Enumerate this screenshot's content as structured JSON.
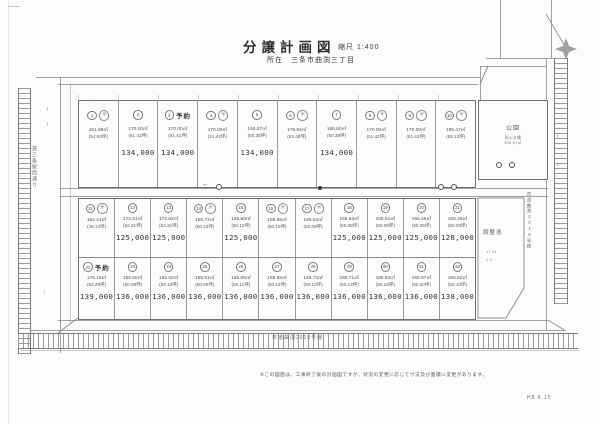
{
  "title": {
    "main": "分譲計画図",
    "scale": "縮尺 1:400",
    "location": "所在　三条市曲渕三丁目"
  },
  "roads": {
    "left_vertical": "燕三条駅西通り",
    "right_vertical": "市道曲渕2018号線",
    "bottom": "市道曲渕2019号線"
  },
  "facilities": {
    "park": {
      "label": "公園",
      "sub1": "防火水槽",
      "sub2": "306.67㎡"
    },
    "pond": {
      "label": "調整池",
      "fine1": "17.11",
      "fine2": "2.9"
    }
  },
  "footer": {
    "note": "※この図面は、工事終了後の計画図ですが、状況の変更に応じて寸法及び面積に変更があります。",
    "date": "H8 6.15"
  },
  "reserved_label": "予約",
  "icons": {
    "stamp_glyph": "✳",
    "arrow_left": "←",
    "arrow_up": "↑",
    "arrow_down": "↓"
  },
  "rows": [
    {
      "lots": [
        {
          "no": "1",
          "stamp": true,
          "reserved": false,
          "area": "181.98㎡",
          "tsubo": "(54.93坪)",
          "price": ""
        },
        {
          "no": "2",
          "stamp": false,
          "reserved": false,
          "area": "170.00㎡",
          "tsubo": "(51.42坪)",
          "price": "134,000"
        },
        {
          "no": "3",
          "stamp": false,
          "reserved": true,
          "area": "170.00㎡",
          "tsubo": "(51.42坪)",
          "price": "134,000"
        },
        {
          "no": "4",
          "stamp": true,
          "reserved": false,
          "area": "170.00㎡",
          "tsubo": "(51.42坪)",
          "price": ""
        },
        {
          "no": "5",
          "stamp": false,
          "reserved": false,
          "area": "166.57㎡",
          "tsubo": "(50.38坪)",
          "price": "134,000"
        },
        {
          "no": "6",
          "stamp": true,
          "reserved": false,
          "area": "176.84㎡",
          "tsubo": "(53.48坪)",
          "price": ""
        },
        {
          "no": "7",
          "stamp": false,
          "reserved": false,
          "area": "166.60㎡",
          "tsubo": "(50.39坪)",
          "price": "134,000"
        },
        {
          "no": "8",
          "stamp": true,
          "reserved": false,
          "area": "170.00㎡",
          "tsubo": "(51.42坪)",
          "price": ""
        },
        {
          "no": "9",
          "stamp": true,
          "reserved": false,
          "area": "170.00㎡",
          "tsubo": "(51.42坪)",
          "price": ""
        },
        {
          "no": "10",
          "stamp": true,
          "reserved": false,
          "area": "195.47㎡",
          "tsubo": "(59.12坪)",
          "price": ""
        }
      ]
    },
    {
      "lots": [
        {
          "no": "11",
          "stamp": true,
          "reserved": false,
          "area": "162.41㎡",
          "tsubo": "(49.13坪)",
          "price": ""
        },
        {
          "no": "12",
          "stamp": false,
          "reserved": false,
          "area": "172.61㎡",
          "tsubo": "(52.21坪)",
          "price": "125,000"
        },
        {
          "no": "13",
          "stamp": false,
          "reserved": false,
          "area": "172.62㎡",
          "tsubo": "(52.21坪)",
          "price": "125,000"
        },
        {
          "no": "14",
          "stamp": true,
          "reserved": false,
          "area": "165.72㎡",
          "tsubo": "(50.13坪)",
          "price": ""
        },
        {
          "no": "15",
          "stamp": false,
          "reserved": false,
          "area": "165.68㎡",
          "tsubo": "(50.12坪)",
          "price": "125,000"
        },
        {
          "no": "16",
          "stamp": true,
          "reserved": false,
          "area": "165.65㎡",
          "tsubo": "(50.10坪)",
          "price": ""
        },
        {
          "no": "17",
          "stamp": true,
          "reserved": false,
          "area": "165.63㎡",
          "tsubo": "(50.09坪)",
          "price": ""
        },
        {
          "no": "18",
          "stamp": false,
          "reserved": false,
          "area": "165.56㎡",
          "tsubo": "(50.08坪)",
          "price": "125,000"
        },
        {
          "no": "19",
          "stamp": false,
          "reserved": false,
          "area": "165.51㎡",
          "tsubo": "(50.06坪)",
          "price": "125,000"
        },
        {
          "no": "20",
          "stamp": false,
          "reserved": false,
          "area": "165.46㎡",
          "tsubo": "(50.05坪)",
          "price": "125,000"
        },
        {
          "no": "21",
          "stamp": false,
          "reserved": false,
          "area": "165.26㎡",
          "tsubo": "(50.03坪)",
          "price": "128,000"
        }
      ]
    },
    {
      "lots": [
        {
          "no": "22",
          "stamp": false,
          "reserved": true,
          "area": "176.16㎡",
          "tsubo": "(53.29坪)",
          "price": "139,000"
        },
        {
          "no": "23",
          "stamp": false,
          "reserved": false,
          "area": "165.60㎡",
          "tsubo": "(50.09坪)",
          "price": "136,000"
        },
        {
          "no": "24",
          "stamp": false,
          "reserved": false,
          "area": "165.62㎡",
          "tsubo": "(50.10坪)",
          "price": "136,000"
        },
        {
          "no": "25",
          "stamp": false,
          "reserved": false,
          "area": "165.61㎡",
          "tsubo": "(50.09坪)",
          "price": "136,000"
        },
        {
          "no": "26",
          "stamp": false,
          "reserved": false,
          "area": "165.65㎡",
          "tsubo": "(50.11坪)",
          "price": "136,000"
        },
        {
          "no": "27",
          "stamp": false,
          "reserved": false,
          "area": "165.68㎡",
          "tsubo": "(50.12坪)",
          "price": "136,000"
        },
        {
          "no": "28",
          "stamp": false,
          "reserved": false,
          "area": "165.72㎡",
          "tsubo": "(50.13坪)",
          "price": "136,000"
        },
        {
          "no": "29",
          "stamp": false,
          "reserved": false,
          "area": "165.71㎡",
          "tsubo": "(50.13坪)",
          "price": "136,000"
        },
        {
          "no": "30",
          "stamp": false,
          "reserved": false,
          "area": "165.84㎡",
          "tsubo": "(50.16坪)",
          "price": "136,000"
        },
        {
          "no": "31",
          "stamp": false,
          "reserved": false,
          "area": "165.97㎡",
          "tsubo": "(50.20坪)",
          "price": "136,000"
        },
        {
          "no": "32",
          "stamp": false,
          "reserved": false,
          "area": "165.62㎡",
          "tsubo": "(50.10坪)",
          "price": "138,000"
        }
      ]
    }
  ]
}
